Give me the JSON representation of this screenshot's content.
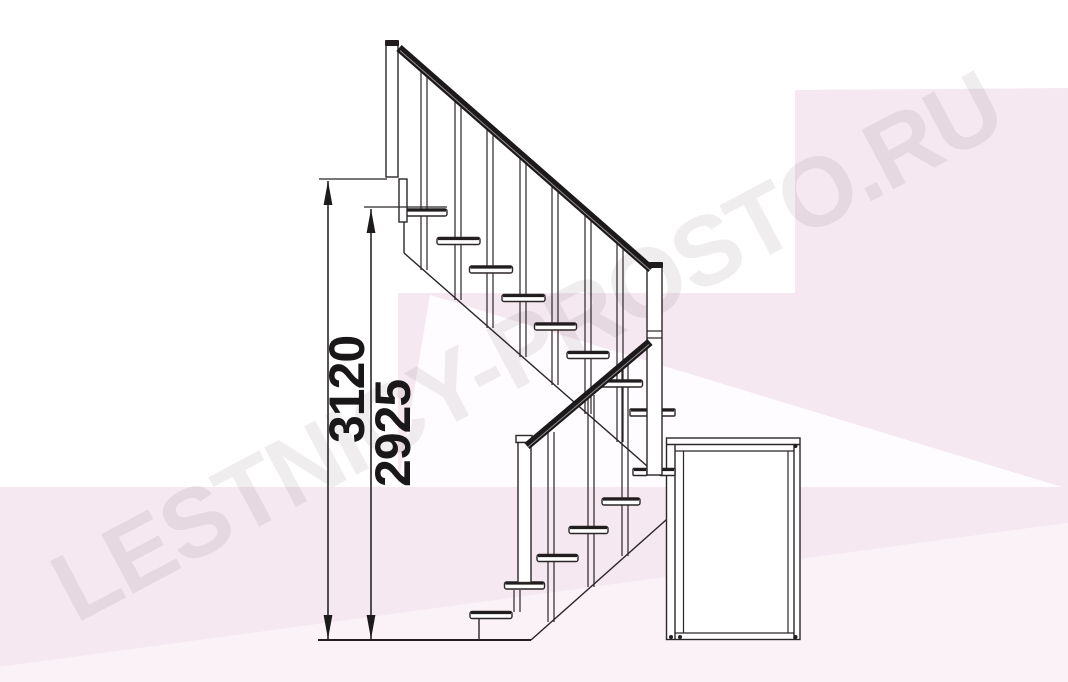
{
  "page": {
    "kind": "staircase-elevation-technical-drawing",
    "background": "#ffffff"
  },
  "watermark": {
    "text": "LESTNICY-PROSTO.RU",
    "color": "#43333f"
  },
  "dimensions": {
    "total_height": {
      "value": "3120"
    },
    "secondary_height": {
      "value": "2925"
    }
  },
  "structure": {
    "upper_flight_treads": 8,
    "lower_flight_treads": 6,
    "has_support_box": true,
    "has_handrails": true
  },
  "colors": {
    "pink_main": "#f6e8f1",
    "pink_light": "#fbf2f8",
    "wedge_white": "#fefcfe",
    "line": "#2b2627",
    "rail": "#1c191a",
    "dim_text": "#1a1718"
  }
}
